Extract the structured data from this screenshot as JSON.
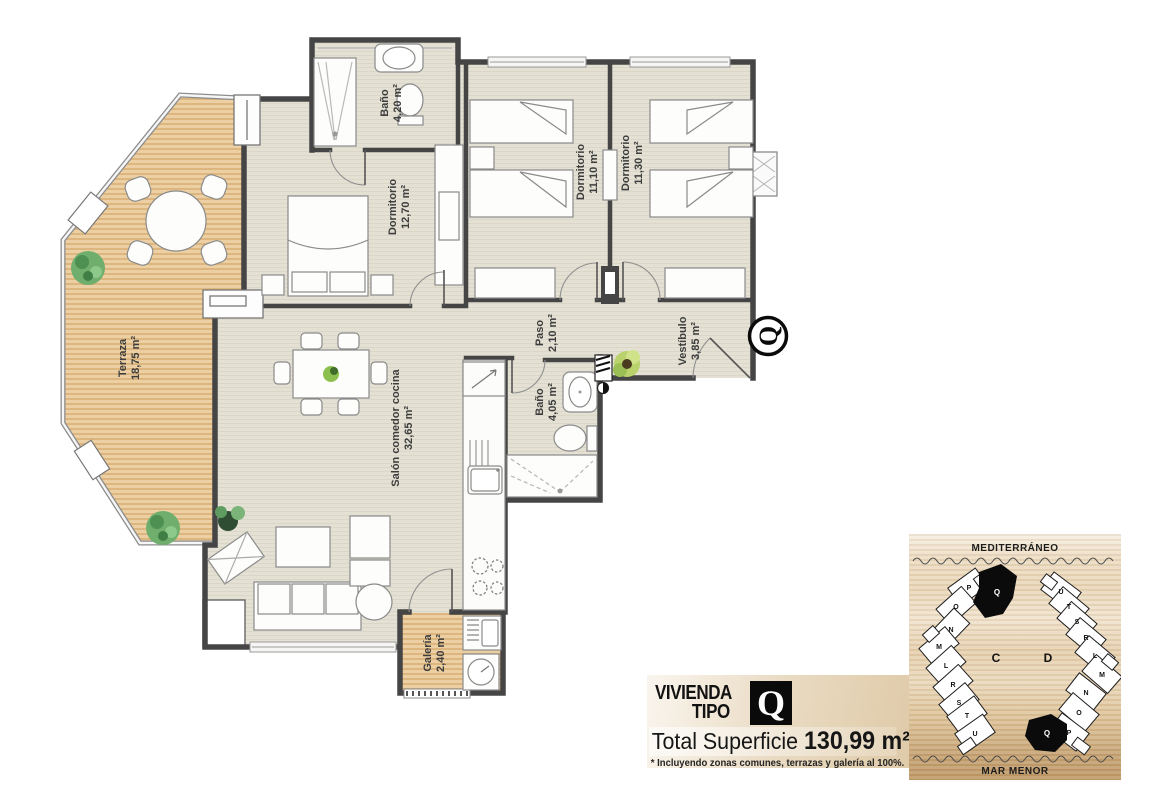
{
  "plan": {
    "rooms": [
      {
        "name": "Baño",
        "area": "4,20 m²"
      },
      {
        "name": "Dormitorio",
        "area": "12,70 m²"
      },
      {
        "name": "Dormitorio",
        "area": "11,10 m²"
      },
      {
        "name": "Dormitorio",
        "area": "11,30 m²"
      },
      {
        "name": "Terraza",
        "area": "18,75 m²"
      },
      {
        "name": "Paso",
        "area": "2,10 m²"
      },
      {
        "name": "Vestíbulo",
        "area": "3,85 m²"
      },
      {
        "name": "Baño",
        "area": "4,05 m²"
      },
      {
        "name": "Salón comedor cocina",
        "area": "32,65 m²"
      },
      {
        "name": "Galería",
        "area": "2,40 m²"
      }
    ],
    "unit_badge": "Q"
  },
  "info_box": {
    "title_line1": "VIVIENDA",
    "title_line2": "TIPO",
    "type_letter": "Q",
    "total_label": "Total Superficie",
    "total_value": "130,99 m²",
    "footnote": "* Incluyendo zonas comunes, terrazas y galería al 100%."
  },
  "site_plan": {
    "sea_top": "MEDITERRÁNEO",
    "sea_bottom": "MAR MENOR",
    "block_c": "C",
    "block_d": "D",
    "building_c_units": [
      "P",
      "Q",
      "O",
      "N",
      "M",
      "L",
      "R",
      "S",
      "T",
      "U"
    ],
    "building_d_units": [
      "U",
      "T",
      "S",
      "R",
      "L",
      "M",
      "N",
      "O",
      "Q",
      "P"
    ]
  },
  "colors": {
    "wall": "#474747",
    "floor": "#e4e1d4",
    "wood": "#e9cb9d",
    "highlight": "#0b0b0b"
  }
}
